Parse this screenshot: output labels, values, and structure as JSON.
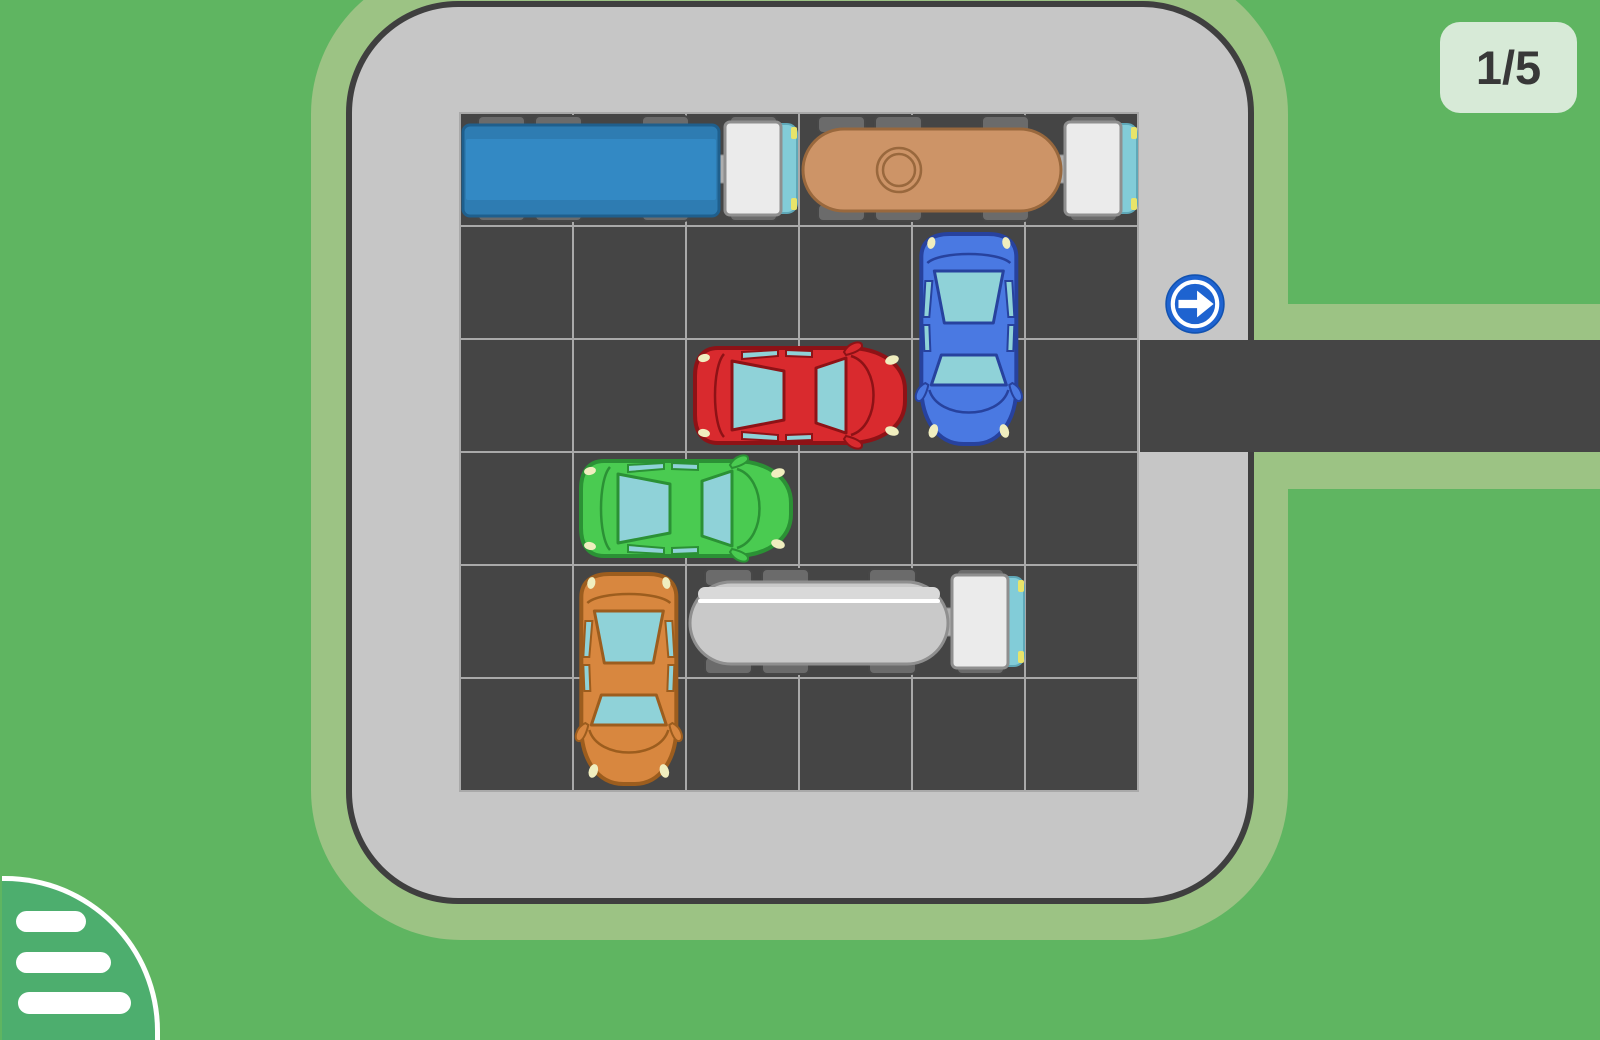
{
  "hud": {
    "level_text": "1/5"
  },
  "board": {
    "rows": 6,
    "cols": 6,
    "exit": {
      "row": 3,
      "side": "right",
      "sign_icon": "arrow-right-icon"
    }
  },
  "menu": {
    "icon": "hamburger-menu-icon"
  },
  "palette": {
    "background": "#5fb561",
    "curb": "#9cc384",
    "lot": "#c6c6c6",
    "lot_border": "#3f3f3f",
    "cell": "#454545",
    "grid_line": "#a9a9a9",
    "road": "#454545",
    "arrow_blue": "#1e63d0",
    "badge_bg": "#d7ead7",
    "badge_text": "#383838",
    "menu_bg": "#4dae6e",
    "window": "#8fd2d8",
    "light": "#f0eebf",
    "wheel": "#6b6b6b",
    "wheel_border": "#474747",
    "cab": "#ebebeb",
    "cab_border": "#8f8f8f",
    "bumper": "#82ccd8",
    "bumper_border": "#5fa8b8",
    "headlight_yellow": "#e8e46a",
    "hitch": "#aeaeae"
  },
  "vehicles": [
    {
      "id": "blue-truck",
      "type": "truck-box",
      "row": 1,
      "col": 1,
      "length": 3,
      "orientation": "horizontal",
      "facing": "right",
      "body": "#3389c4",
      "accent": "#2e7cb2",
      "outline": "#1f5f8d"
    },
    {
      "id": "tan-tanker-truck",
      "type": "truck-tank",
      "variant": "manhole",
      "row": 1,
      "col": 4,
      "length": 3,
      "orientation": "horizontal",
      "facing": "right",
      "body": "#cd9467",
      "accent": "#cd9467",
      "outline": "#99683d"
    },
    {
      "id": "blue-car",
      "type": "car",
      "row": 2,
      "col": 5,
      "length": 2,
      "orientation": "vertical",
      "facing": "down",
      "body": "#4a79e2",
      "outline": "#27429e"
    },
    {
      "id": "red-car",
      "type": "car",
      "row": 3,
      "col": 3,
      "length": 2,
      "orientation": "horizontal",
      "facing": "right",
      "body": "#d92a2e",
      "outline": "#8e1216"
    },
    {
      "id": "green-car",
      "type": "car",
      "row": 4,
      "col": 2,
      "length": 2,
      "orientation": "horizontal",
      "facing": "right",
      "body": "#4acb51",
      "outline": "#2b9135"
    },
    {
      "id": "orange-car",
      "type": "car",
      "row": 5,
      "col": 2,
      "length": 2,
      "orientation": "vertical",
      "facing": "down",
      "body": "#d8873f",
      "outline": "#9c5d1e"
    },
    {
      "id": "white-tanker-truck",
      "type": "truck-tank",
      "variant": "stripe",
      "row": 5,
      "col": 3,
      "length": 3,
      "orientation": "horizontal",
      "facing": "right",
      "body": "#c9c9c9",
      "accent": "#d9d9d9",
      "outline": "#8f8f8f"
    }
  ]
}
